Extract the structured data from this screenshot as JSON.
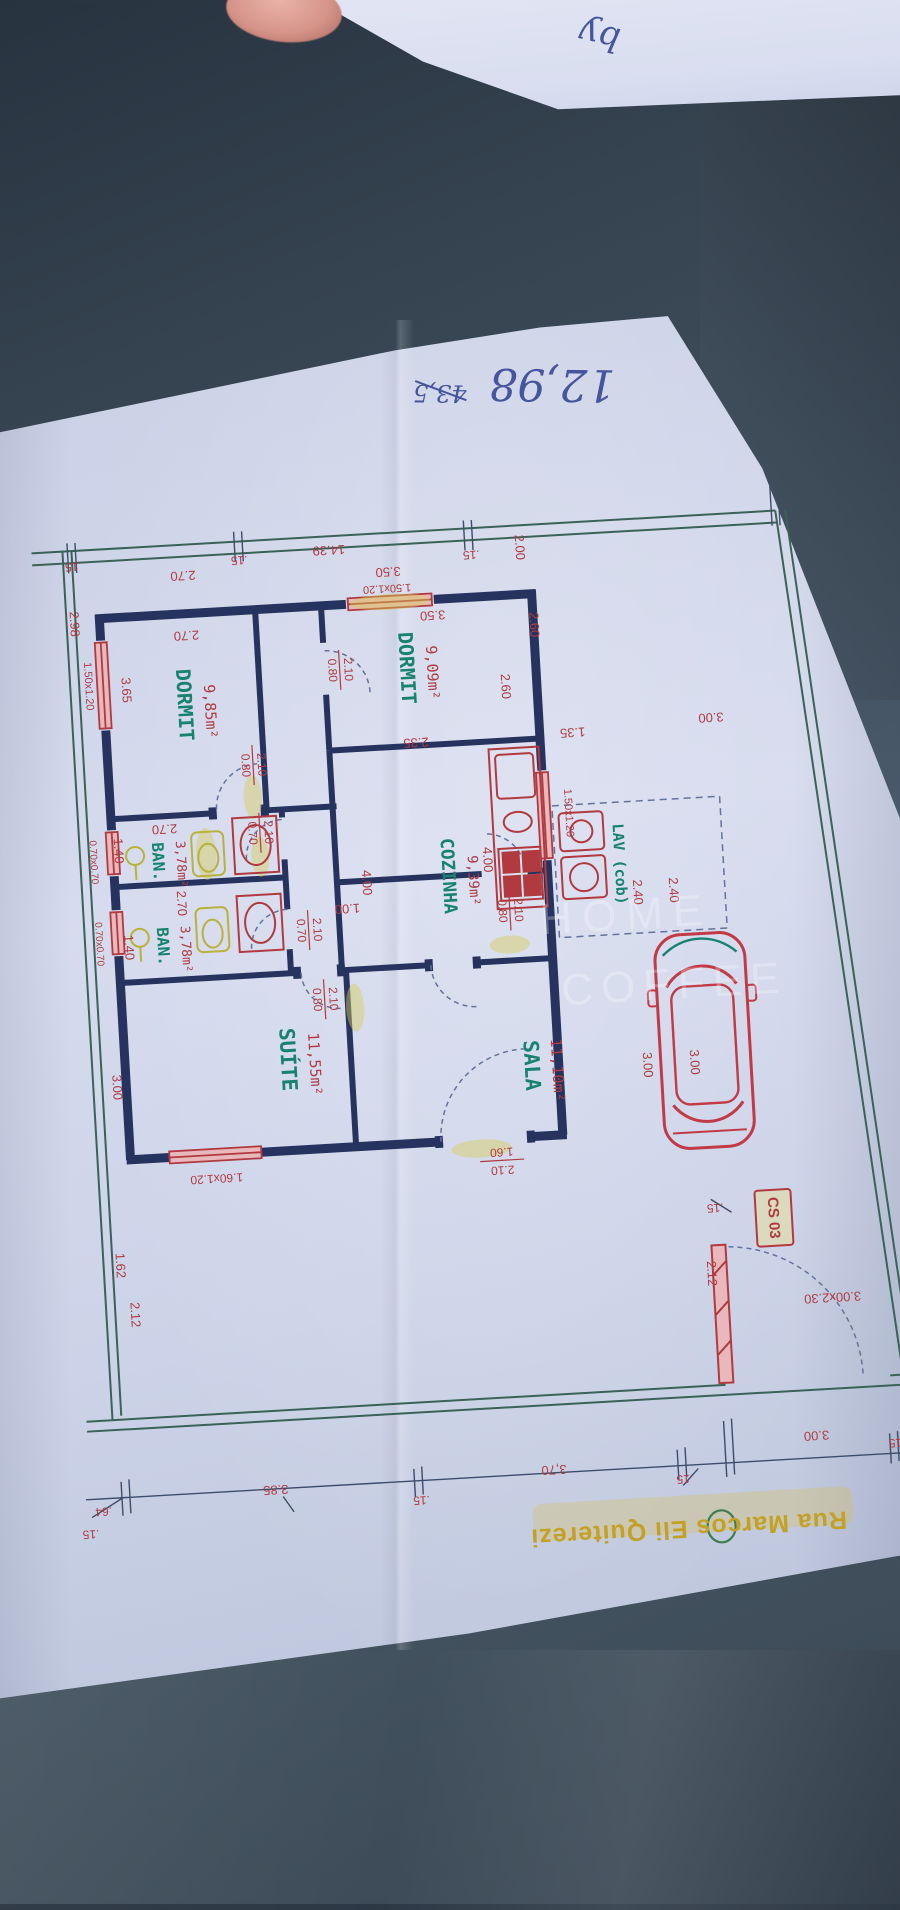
{
  "palette": {
    "red": "#b03a3f",
    "teal": "#17836f",
    "navy": "#27335f",
    "green": "#3a6257",
    "yellow": "#c2a125",
    "ink": "#45569e",
    "wm": "rgba(255,255,255,0.27)",
    "paper": "#ccd3e8",
    "table": "#41505f",
    "window": "#e8b8bc",
    "highlight": "rgba(214,205,90,0.45)"
  },
  "rooms": [
    {
      "name": "DORMIT",
      "area": "9,85m²"
    },
    {
      "name": "DORMIT",
      "area": "9,09m²"
    },
    {
      "name": "BAN.",
      "area": "3,78m²"
    },
    {
      "name": "BAN.",
      "area": "3,78m²"
    },
    {
      "name": "COZINHA",
      "area": "9,39m²"
    },
    {
      "name": "SUÍTE",
      "area": "11,55m²"
    },
    {
      "name": "SALA",
      "area": "11,10m²"
    },
    {
      "name": "LAV (cob)",
      "area": ""
    }
  ],
  "street": {
    "name": "Rua Marcos Eli Quiterezi"
  },
  "plan_code": "CS 03",
  "gate_size": "3.00x2.30",
  "handwriting": {
    "main": "12,98",
    "struck": "43,5",
    "scrap": "by"
  },
  "watermark": {
    "line1": "HOME",
    "line2": "COFFEE"
  },
  "labels": [
    {
      "t": ".15",
      "x": 96,
      "y": 545,
      "r": 180,
      "c": "red",
      "s": 12,
      "n": "dim-top-15a"
    },
    {
      "t": "2.70",
      "x": 205,
      "y": 560,
      "r": 180,
      "c": "red",
      "s": 13,
      "n": "dim-top-270"
    },
    {
      "t": ".15",
      "x": 262,
      "y": 548,
      "r": 180,
      "c": "red",
      "s": 12,
      "n": "dim-top-15b"
    },
    {
      "t": "14.39",
      "x": 352,
      "y": 543,
      "r": 180,
      "c": "red",
      "s": 13,
      "n": "dim-terrain-width"
    },
    {
      "t": "3.50",
      "x": 410,
      "y": 568,
      "r": 180,
      "c": "red",
      "s": 13,
      "n": "dim-350a"
    },
    {
      "t": "1.50x1.20",
      "x": 408,
      "y": 585,
      "r": 180,
      "c": "red",
      "s": 11,
      "n": "window-label-d2"
    },
    {
      "t": "3.50",
      "x": 452,
      "y": 614,
      "r": 180,
      "c": "red",
      "s": 13,
      "n": "dim-350b"
    },
    {
      "t": ".15",
      "x": 494,
      "y": 556,
      "r": 180,
      "c": "red",
      "s": 12,
      "n": "dim-top-15c"
    },
    {
      "t": "2.00",
      "x": 542,
      "y": 552,
      "r": 90,
      "c": "red",
      "s": 13,
      "n": "dim-setback-200"
    },
    {
      "t": "2.98",
      "x": 93,
      "y": 603,
      "r": 90,
      "c": "red",
      "s": 13,
      "n": "dim-left-298"
    },
    {
      "t": "2.70",
      "x": 205,
      "y": 620,
      "r": 180,
      "c": "red",
      "s": 13,
      "n": "dim-d1-width"
    },
    {
      "t": "DORMIT",
      "x": 198,
      "y": 690,
      "r": 90,
      "c": "teal",
      "s": 20,
      "f": "mono",
      "w": 700,
      "n": "room-dormit-1"
    },
    {
      "t": "9,85m²",
      "x": 224,
      "y": 698,
      "r": 90,
      "c": "red",
      "s": 15,
      "f": "mono",
      "n": "area-dormit-1"
    },
    {
      "t": "3.65",
      "x": 141,
      "y": 672,
      "r": 90,
      "c": "red",
      "s": 13,
      "n": "dim-d1-depth"
    },
    {
      "t": "1.50x1.20",
      "x": 104,
      "y": 666,
      "r": 90,
      "c": "red",
      "s": 11,
      "n": "window-label-d1"
    },
    {
      "t": "DORMIT",
      "x": 422,
      "y": 666,
      "r": 90,
      "c": "teal",
      "s": 20,
      "f": "mono",
      "w": 700,
      "n": "room-dormit-2"
    },
    {
      "t": "9,09m²",
      "x": 448,
      "y": 672,
      "r": 90,
      "c": "red",
      "s": 15,
      "f": "mono",
      "n": "area-dormit-2"
    },
    {
      "t": "2.60",
      "x": 552,
      "y": 630,
      "r": 90,
      "c": "red",
      "s": 13,
      "n": "dim-d2-260a"
    },
    {
      "t": "2.60",
      "x": 520,
      "y": 690,
      "r": 90,
      "c": "red",
      "s": 13,
      "n": "dim-d2-260b"
    },
    {
      "t": "0.80",
      "x": 348,
      "y": 664,
      "r": 90,
      "c": "red",
      "s": 12,
      "n": "door-d2-w"
    },
    {
      "t": "2.10",
      "x": 364,
      "y": 664,
      "r": 90,
      "c": "red",
      "s": 12,
      "n": "door-d2-h"
    },
    {
      "t": "2.70",
      "x": 172,
      "y": 812,
      "r": 180,
      "c": "red",
      "s": 13,
      "n": "dim-ban1-270"
    },
    {
      "t": "0.80",
      "x": 256,
      "y": 754,
      "r": 90,
      "c": "red",
      "s": 12,
      "n": "door-d1-w"
    },
    {
      "t": "2.10",
      "x": 272,
      "y": 754,
      "r": 90,
      "c": "red",
      "s": 12,
      "n": "door-d1-h"
    },
    {
      "t": "0.70",
      "x": 259,
      "y": 822,
      "r": 90,
      "c": "red",
      "s": 12,
      "n": "door-ban1-w"
    },
    {
      "t": "2.10",
      "x": 275,
      "y": 822,
      "r": 90,
      "c": "red",
      "s": 12,
      "n": "door-ban1-h"
    },
    {
      "t": "1.40",
      "x": 124,
      "y": 832,
      "r": 90,
      "c": "red",
      "s": 13,
      "n": "dim-ban1-140"
    },
    {
      "t": "0.70x0.70",
      "x": 99,
      "y": 842,
      "r": 90,
      "c": "red",
      "s": 10,
      "n": "window-label-ban1"
    },
    {
      "t": "BAN.",
      "x": 163,
      "y": 845,
      "r": 90,
      "c": "teal",
      "s": 16,
      "f": "mono",
      "w": 700,
      "n": "room-ban-1"
    },
    {
      "t": "3,78m²",
      "x": 186,
      "y": 849,
      "r": 90,
      "c": "red",
      "s": 13,
      "f": "mono",
      "n": "area-ban-1"
    },
    {
      "t": "2.70",
      "x": 184,
      "y": 888,
      "r": 90,
      "c": "red",
      "s": 13,
      "n": "dim-ban2-270"
    },
    {
      "t": "1.40",
      "x": 129,
      "y": 929,
      "r": 90,
      "c": "red",
      "s": 13,
      "n": "dim-ban2-140"
    },
    {
      "t": "0.70x0.70",
      "x": 100,
      "y": 924,
      "r": 90,
      "c": "red",
      "s": 10,
      "n": "window-label-ban2"
    },
    {
      "t": "BAN.",
      "x": 163,
      "y": 930,
      "r": 90,
      "c": "teal",
      "s": 16,
      "f": "mono",
      "w": 700,
      "n": "room-ban-2"
    },
    {
      "t": "3,78m²",
      "x": 186,
      "y": 934,
      "r": 90,
      "c": "red",
      "s": 13,
      "f": "mono",
      "n": "area-ban-2"
    },
    {
      "t": "0.70",
      "x": 302,
      "y": 922,
      "r": 90,
      "c": "red",
      "s": 12,
      "n": "door-ban2-w"
    },
    {
      "t": "2.10",
      "x": 318,
      "y": 922,
      "r": 90,
      "c": "red",
      "s": 12,
      "n": "door-ban2-h"
    },
    {
      "t": "1.00",
      "x": 350,
      "y": 902,
      "r": 180,
      "c": "red",
      "s": 13,
      "n": "dim-hall-100"
    },
    {
      "t": "2.35",
      "x": 428,
      "y": 740,
      "r": 180,
      "c": "red",
      "s": 13,
      "n": "dim-coz-235"
    },
    {
      "t": "4.00",
      "x": 370,
      "y": 878,
      "r": 90,
      "c": "red",
      "s": 13,
      "n": "dim-coz-400a"
    },
    {
      "t": "4.00",
      "x": 492,
      "y": 862,
      "r": 90,
      "c": "red",
      "s": 13,
      "n": "dim-coz-400b"
    },
    {
      "t": "COZINHA",
      "x": 452,
      "y": 876,
      "r": 90,
      "c": "teal",
      "s": 18,
      "f": "mono",
      "w": 700,
      "n": "room-cozinha"
    },
    {
      "t": "9,39m²",
      "x": 477,
      "y": 882,
      "r": 90,
      "c": "red",
      "s": 14,
      "f": "mono",
      "n": "area-cozinha"
    },
    {
      "t": "0.80",
      "x": 504,
      "y": 914,
      "r": 90,
      "c": "red",
      "s": 12,
      "n": "door-coz-w"
    },
    {
      "t": "2.10",
      "x": 520,
      "y": 914,
      "r": 90,
      "c": "red",
      "s": 12,
      "n": "door-coz-h"
    },
    {
      "t": "1.35",
      "x": 585,
      "y": 739,
      "r": 180,
      "c": "red",
      "s": 13,
      "n": "dim-135"
    },
    {
      "t": "3.00",
      "x": 724,
      "y": 732,
      "r": 180,
      "c": "red",
      "s": 13,
      "n": "dim-setback-300"
    },
    {
      "t": "1.50x1.20",
      "x": 576,
      "y": 820,
      "r": 90,
      "c": "red",
      "s": 11,
      "n": "window-label-coz"
    },
    {
      "t": "LAV (cob)",
      "x": 624,
      "y": 874,
      "r": 90,
      "c": "teal",
      "s": 15,
      "f": "mono",
      "w": 700,
      "n": "room-lav"
    },
    {
      "t": "2.40",
      "x": 640,
      "y": 903,
      "r": 90,
      "c": "red",
      "s": 13,
      "n": "dim-240a"
    },
    {
      "t": "2.40",
      "x": 676,
      "y": 903,
      "r": 90,
      "c": "red",
      "s": 13,
      "n": "dim-240b"
    },
    {
      "t": "3.00",
      "x": 640,
      "y": 1076,
      "r": 90,
      "c": "red",
      "s": 13,
      "n": "dim-garage-300a"
    },
    {
      "t": "3.00",
      "x": 687,
      "y": 1076,
      "r": 90,
      "c": "red",
      "s": 13,
      "n": "dim-garage-300b"
    },
    {
      "t": "0.80",
      "x": 314,
      "y": 992,
      "r": 90,
      "c": "red",
      "s": 12,
      "n": "door-hall-w"
    },
    {
      "t": "2.10",
      "x": 330,
      "y": 992,
      "r": 90,
      "c": "red",
      "s": 12,
      "n": "door-hall-h"
    },
    {
      "t": "SUÍTE",
      "x": 281,
      "y": 1050,
      "r": 90,
      "c": "teal",
      "s": 21,
      "f": "mono",
      "w": 700,
      "n": "room-suite"
    },
    {
      "t": "11,55m²",
      "x": 308,
      "y": 1056,
      "r": 90,
      "c": "red",
      "s": 15,
      "f": "mono",
      "n": "area-suite"
    },
    {
      "t": "SALA",
      "x": 524,
      "y": 1070,
      "r": 90,
      "c": "teal",
      "s": 21,
      "f": "mono",
      "w": 700,
      "n": "room-sala"
    },
    {
      "t": "11,10m²",
      "x": 550,
      "y": 1076,
      "r": 90,
      "c": "red",
      "s": 15,
      "f": "mono",
      "n": "area-sala"
    },
    {
      "t": "3.00",
      "x": 109,
      "y": 1068,
      "r": 90,
      "c": "red",
      "s": 13,
      "n": "dim-suite-300"
    },
    {
      "t": "1.60",
      "x": 490,
      "y": 1154,
      "r": 180,
      "c": "red",
      "s": 12,
      "n": "door-front-w"
    },
    {
      "t": "2.10",
      "x": 490,
      "y": 1172,
      "r": 180,
      "c": "red",
      "s": 12,
      "n": "door-front-h"
    },
    {
      "t": "1.60x1.20",
      "x": 204,
      "y": 1164,
      "r": 180,
      "c": "red",
      "s": 12,
      "n": "window-label-suite"
    },
    {
      "t": "1.62",
      "x": 102,
      "y": 1246,
      "r": 90,
      "c": "red",
      "s": 13,
      "n": "dim-162"
    },
    {
      "t": "2.12",
      "x": 114,
      "y": 1296,
      "r": 90,
      "c": "red",
      "s": 13,
      "n": "dim-212-left"
    },
    {
      "t": ".15",
      "x": 700,
      "y": 1222,
      "r": 180,
      "c": "red",
      "s": 12,
      "n": "dim-gate-15"
    },
    {
      "t": "2.12",
      "x": 692,
      "y": 1288,
      "r": 90,
      "c": "red",
      "s": 13,
      "n": "dim-212-gate"
    },
    {
      "t": "CS 03",
      "x": 757,
      "y": 1236,
      "r": 90,
      "c": "red",
      "s": 15,
      "w": 700,
      "n": "plan-code"
    },
    {
      "t": "3.00x2.30",
      "x": 812,
      "y": 1318,
      "r": 180,
      "c": "red",
      "s": 13,
      "n": "gate-size-label"
    },
    {
      "t": ".64",
      "x": 72,
      "y": 1490,
      "r": 180,
      "c": "red",
      "s": 12,
      "n": "dim-bot-64"
    },
    {
      "t": ".15",
      "x": 58,
      "y": 1512,
      "r": 180,
      "c": "red",
      "s": 12,
      "n": "dim-bot-15a"
    },
    {
      "t": "3.85",
      "x": 245,
      "y": 1478,
      "r": 180,
      "c": "red",
      "s": 13,
      "n": "dim-bot-385"
    },
    {
      "t": ".15",
      "x": 390,
      "y": 1497,
      "r": 180,
      "c": "red",
      "s": 12,
      "n": "dim-bot-15b"
    },
    {
      "t": "3,70",
      "x": 524,
      "y": 1474,
      "r": 180,
      "c": "red",
      "s": 13,
      "n": "dim-bot-370"
    },
    {
      "t": ".15",
      "x": 654,
      "y": 1491,
      "r": 180,
      "c": "red",
      "s": 12,
      "n": "dim-bot-15c"
    },
    {
      "t": "3.00",
      "x": 788,
      "y": 1455,
      "r": 180,
      "c": "red",
      "s": 13,
      "n": "dim-bot-300"
    },
    {
      "t": ".15",
      "x": 868,
      "y": 1467,
      "r": 180,
      "c": "red",
      "s": 12,
      "n": "dim-bot-15d"
    },
    {
      "t": "Rua Marcos Eli Quiterezi",
      "x": 655,
      "y": 1540,
      "r": 180,
      "c": "yellow",
      "s": 25,
      "w": 700,
      "ls": 1,
      "n": "street-name"
    },
    {
      "t": "HOME",
      "x": 628,
      "y": 928,
      "r": 0,
      "c": "wm",
      "s": 44,
      "ls": 10,
      "n": "watermark-line1"
    },
    {
      "t": "COFFEE",
      "x": 672,
      "y": 1000,
      "r": 0,
      "c": "wm",
      "s": 44,
      "ls": 8,
      "n": "watermark-line2"
    },
    {
      "t": "12,98",
      "x": 585,
      "y": 388,
      "r": 184,
      "c": "ink",
      "s": 44,
      "f": "ital",
      "n": "handwriting-main"
    },
    {
      "t": "43,5",
      "x": 472,
      "y": 392,
      "r": 184,
      "c": "ink",
      "s": 24,
      "f": "ital",
      "n": "handwriting-struck"
    }
  ],
  "overlay_labels": [
    {
      "t": "by",
      "x": 600,
      "y": 34,
      "r": 192,
      "c": "ink",
      "s": 34,
      "f": "ital",
      "n": "scrap-scribble"
    }
  ]
}
